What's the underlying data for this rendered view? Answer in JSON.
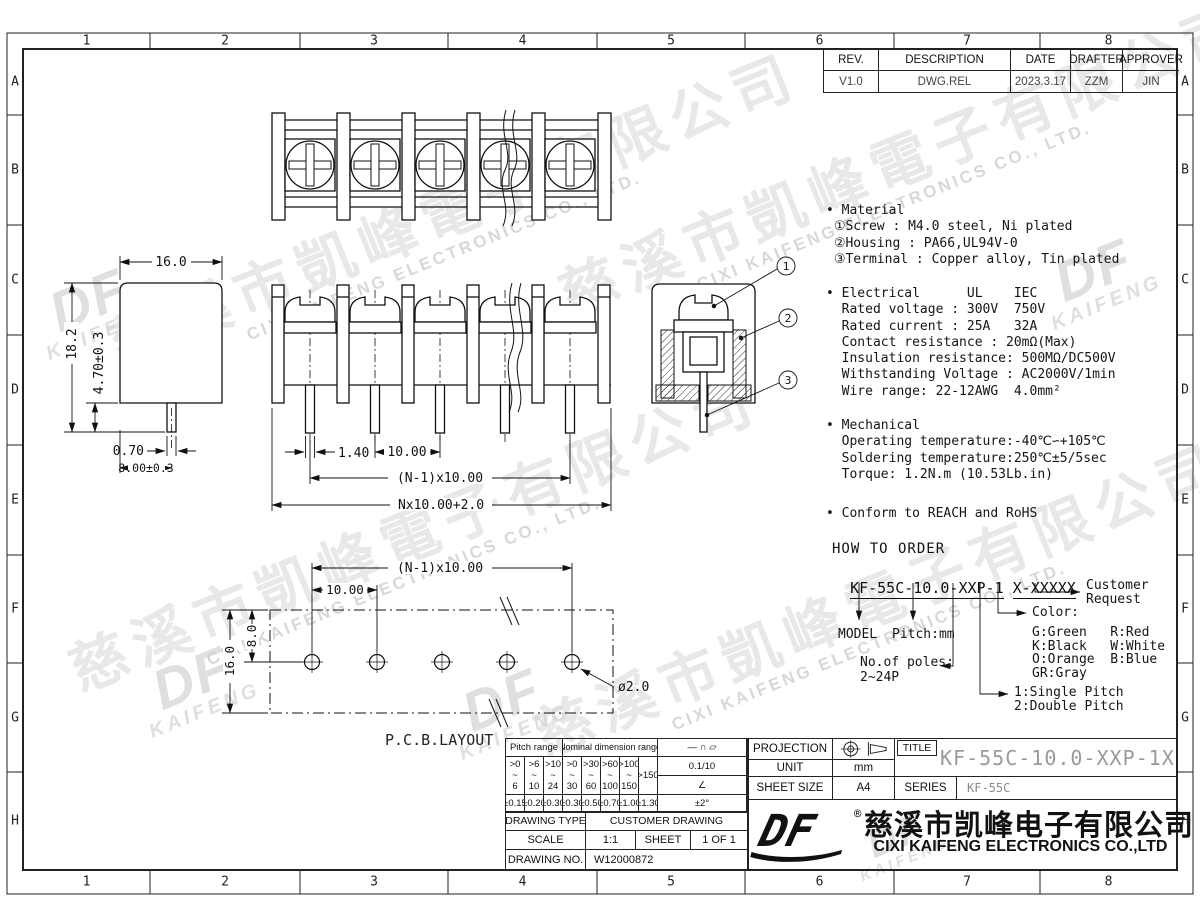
{
  "sheet": {
    "grid_cols": [
      "1",
      "2",
      "3",
      "4",
      "5",
      "6",
      "7",
      "8"
    ],
    "grid_rows": [
      "A",
      "B",
      "C",
      "D",
      "E",
      "F",
      "G",
      "H"
    ]
  },
  "revision_table": {
    "headers": [
      "REV.",
      "DESCRIPTION",
      "DATE",
      "DRAFTER",
      "APPROVER"
    ],
    "rows": [
      [
        "V1.0",
        "DWG.REL",
        "2023.3.17",
        "ZZM",
        "JIN"
      ]
    ]
  },
  "specs": {
    "material": "• Material\n ①Screw : M4.0 steel, Ni plated\n ②Housing : PA66,UL94V-0\n ③Terminal : Copper alloy, Tin plated",
    "electrical": "• Electrical      UL    IEC\n  Rated voltage : 300V  750V\n  Rated current : 25A   32A\n  Contact resistance : 20mΩ(Max)\n  Insulation resistance: 500MΩ/DC500V\n  Withstanding Voltage : AC2000V/1min\n  Wire range: 22-12AWG  4.0mm²",
    "mechanical": "• Mechanical\n  Operating temperature:-40℃∽+105℃\n  Soldering temperature:250℃±5/5sec\n  Torque: 1.2N.m (10.53Lb.in)",
    "conform": "• Conform to REACH and RoHS"
  },
  "order": {
    "heading": "HOW TO ORDER",
    "segments": [
      "KF-55C",
      "-",
      "10.0",
      "-",
      "XXP",
      "-",
      "1",
      " ",
      "X",
      "-",
      "XXXXX"
    ],
    "model": "MODEL",
    "pitch": "Pitch:mm",
    "poles_label": "No.of poles:",
    "poles_range": "2~24P",
    "color_label": "Color:",
    "colors": "G:Green   R:Red\nK:Black   W:White\nO:Orange  B:Blue\nGR:Gray",
    "single": "1:Single Pitch",
    "double": "2:Double Pitch",
    "customer": "Customer\nRequest"
  },
  "dims": {
    "side": {
      "w": "16.0",
      "h": "18.2",
      "pin": "4.70±0.3",
      "pin_w": "0.70",
      "depth": "8.00±0.3"
    },
    "front": {
      "pin_w": "1.40",
      "pitch": "10.00",
      "span": "(N-1)x10.00",
      "total": "Nx10.00+2.0"
    },
    "pcb": {
      "span": "(N-1)x10.00",
      "pitch": "10.00",
      "row": "8.0",
      "h": "16.0",
      "hole": "ø2.0",
      "label": "P.C.B.LAYOUT"
    }
  },
  "section": {
    "balloons": [
      "1",
      "2",
      "3"
    ]
  },
  "tol": {
    "pitch_header": "Pitch range",
    "nominal_header": "Nominal dimension range",
    "syms": "— ∩ ▱",
    "ranges": [
      ">0\n~\n6",
      ">6\n~\n10",
      ">10\n~\n24",
      ">0\n~\n30",
      ">30\n~\n60",
      ">60\n~\n100",
      ">100\n~\n150"
    ],
    "range_last": ">150",
    "flat": "0.1/10",
    "angle": "∠",
    "tols": [
      "±0.15",
      "±0.20",
      "±0.30",
      "±0.30",
      "±0.50",
      "±0.70",
      "±1.00",
      "±1.30"
    ],
    "angle_tol": "±2°"
  },
  "tb": {
    "projection": "PROJECTION",
    "title_label": "TITLE",
    "title": "KF-55C-10.0-XXP-1X",
    "unit_label": "UNIT",
    "unit": "mm",
    "sheet_size_label": "SHEET SIZE",
    "sheet_size": "A4",
    "series_label": "SERIES",
    "series": "KF-55C",
    "drawing_type_label": "DRAWING TYPE",
    "drawing_type": "CUSTOMER DRAWING",
    "scale_label": "SCALE",
    "scale": "1:1",
    "sheet_label": "SHEET",
    "sheet": "1 OF 1",
    "drawing_no_label": "DRAWING NO.",
    "drawing_no": "W12000872"
  },
  "company": {
    "logo": "DF",
    "reg": "®",
    "cn": "慈溪市凯峰电子有限公司",
    "en": "CIXI KAIFENG ELECTRONICS CO.,LTD"
  },
  "watermark": {
    "cn": "慈溪市凱峰電子有限公司",
    "en": "CIXI KAIFENG ELECTRONICS CO., LTD.",
    "logo": "DF",
    "logo_sub": "KAIFENG"
  }
}
